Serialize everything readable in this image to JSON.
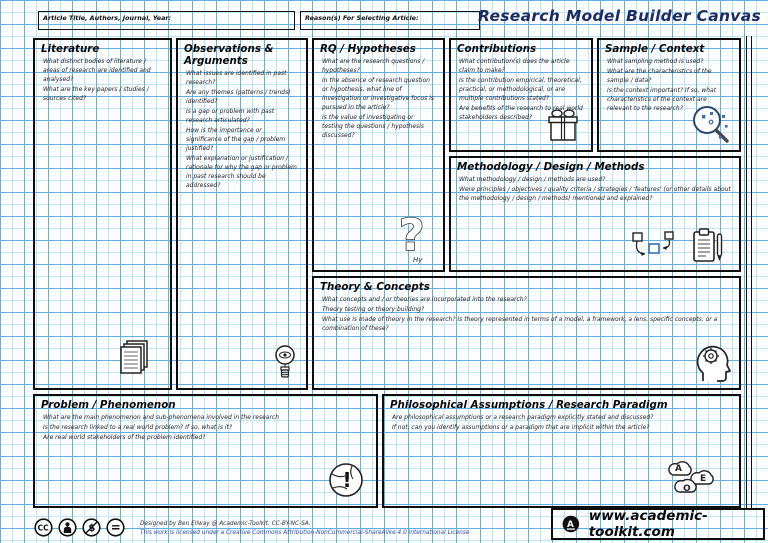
{
  "header": {
    "article_label": "Article Title, Authors, Journal, Year:",
    "reason_label": "Reason(s) For Selecting Article:",
    "title": "Research Model Builder Canvas"
  },
  "boxes": {
    "literature": {
      "title": "Literature",
      "questions": [
        "What distinct bodies of literature / areas of research are identified and analysed?",
        "What are the key papers / studies / sources cited?"
      ]
    },
    "observations": {
      "title": "Observations & Arguments",
      "questions": [
        "What issues are identified in past research?",
        "Are any themes (patterns / trends) identified?",
        "Is a gap or problem with past research articulated?",
        "How is the importance or significance of the gap / problem justified?",
        "What explanation or justification / rationale for why the gap or problem in past research should be addressed?"
      ]
    },
    "rq": {
      "title": "RQ / Hypotheses",
      "questions": [
        "What are the research questions / hypotheses?",
        "In the absence of research question or hypothesis, what line of investigation or investigative focus is pursued in the article?",
        "Is the value of investigating or testing the questions / hypothesis discussed?"
      ]
    },
    "contributions": {
      "title": "Contributions",
      "questions": [
        "What contribution(s) does the article claim to make?",
        "Is the contribution empirical, theoretical, practical, or methodological, or are multiple contributions stated?",
        "Are benefits of the research to real world stakeholders described?"
      ]
    },
    "sample": {
      "title": "Sample / Context",
      "questions": [
        "What sampling method is used?",
        "What are the characteristics of the sample / data?",
        "Is the context important? If so, what characteristics of the context are relevant to the research?"
      ]
    },
    "methodology": {
      "title": "Methodology / Design / Methods",
      "questions": [
        "What methodology / design / methods are used?",
        "Were principles / objectives / quality criteria / strategies / 'features' (or other details about the methodology / design / methods) mentioned and explained?"
      ]
    },
    "theory": {
      "title": "Theory & Concepts",
      "questions": [
        "What concepts and / or theories are incorporated into the research?",
        "Theory testing or theory building?",
        "What use is made of theory in the research? Is theory represented in terms of a model, a framework, a lens, specific concepts, or a combination of these?"
      ]
    },
    "problem": {
      "title": "Problem / Phenomenon",
      "questions": [
        "What are the main phenomenon and sub-phenomena involved in the research",
        "Is the research linked to a real world problem? If so, what is it?",
        "Are real world stakeholders of the problem identified?"
      ]
    },
    "philosophy": {
      "title": "Philosophical Assumptions / Research Paradigm",
      "questions": [
        "Are philosophical assumptions or a research paradigm explicitly stated and discussed?",
        "If not, can you identify assumptions or a paradigm that are implicit within the article?"
      ]
    }
  },
  "icons": {
    "rq_caption": "Hy",
    "cloud_letters": {
      "a": "A",
      "e": "E",
      "o": "O"
    },
    "license_cc": "CC",
    "license_nc": "$",
    "license_eq": "=",
    "logo_letter": "A"
  },
  "footer": {
    "credit_line1": "Designed by Ben Ellway @ Academic-Toolkit. CC-BY-NC-SA.",
    "credit_line2": "This work is licensed under a Creative Commons Attribution-NonCommercial-ShareAlike 4.0 International License",
    "website": "www.academic-toolkit.com"
  },
  "colors": {
    "grid_minor": "#c2e4f7",
    "grid_major": "#63afe2",
    "title_ink": "#1c2a66",
    "ink": "#0d0d0d",
    "accent_blue": "#3b6fb5"
  }
}
